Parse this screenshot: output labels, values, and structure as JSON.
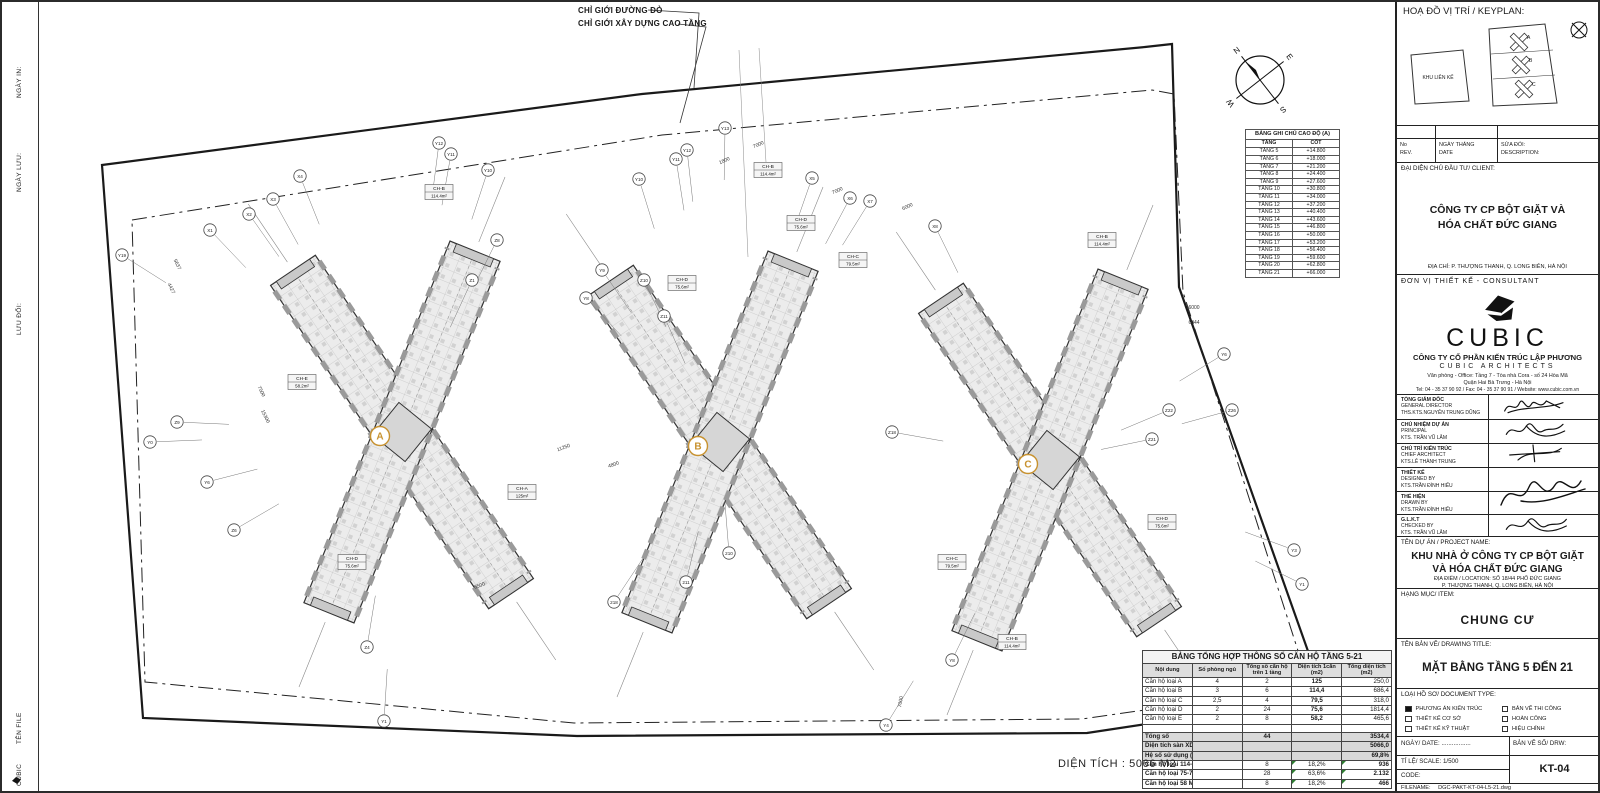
{
  "sheet": {
    "side_labels": [
      {
        "text": "NGÀY IN:",
        "top": 96
      },
      {
        "text": "NGÀY LƯU:",
        "top": 190
      },
      {
        "text": "LƯU ĐỔI:",
        "top": 333
      },
      {
        "text": "TÊN FILE",
        "top": 742
      },
      {
        "text": "CUBIC",
        "top": 784
      }
    ],
    "area_note": "DIỆN TÍCH : 5066 M2"
  },
  "drawing": {
    "boundary_label_1": "CHỈ GIỚI ĐƯỜNG ĐỎ",
    "boundary_label_2": "CHỈ GIỚI XÂY DỰNG CAO TẦNG",
    "tower_label_color": "#c8922f",
    "towers": [
      {
        "label": "A",
        "x": 400,
        "y": 430,
        "rot": -6
      },
      {
        "label": "B",
        "x": 718,
        "y": 440,
        "rot": -6
      },
      {
        "label": "C",
        "x": 1048,
        "y": 458,
        "rot": -6
      }
    ],
    "compass": {
      "n": "N",
      "e": "E",
      "s": "S",
      "w": "W"
    },
    "grid_bubbles": [
      {
        "l": "X1",
        "x": 208,
        "y": 228
      },
      {
        "l": "X2",
        "x": 247,
        "y": 212
      },
      {
        "l": "X3",
        "x": 271,
        "y": 197
      },
      {
        "l": "X4",
        "x": 298,
        "y": 174
      },
      {
        "l": "Y19",
        "x": 120,
        "y": 253
      },
      {
        "l": "Y12",
        "x": 437,
        "y": 141
      },
      {
        "l": "Y11",
        "x": 449,
        "y": 152
      },
      {
        "l": "Y10",
        "x": 486,
        "y": 168
      },
      {
        "l": "Z8",
        "x": 495,
        "y": 238
      },
      {
        "l": "Z1",
        "x": 470,
        "y": 278
      },
      {
        "l": "Y9",
        "x": 600,
        "y": 268
      },
      {
        "l": "Y8",
        "x": 584,
        "y": 296
      },
      {
        "l": "Z10",
        "x": 642,
        "y": 278
      },
      {
        "l": "Z11",
        "x": 662,
        "y": 314
      },
      {
        "l": "Z9",
        "x": 175,
        "y": 420
      },
      {
        "l": "Y0",
        "x": 148,
        "y": 440
      },
      {
        "l": "Y6",
        "x": 205,
        "y": 480
      },
      {
        "l": "Z6",
        "x": 232,
        "y": 528
      },
      {
        "l": "Z4",
        "x": 365,
        "y": 645
      },
      {
        "l": "Y1",
        "x": 382,
        "y": 719
      },
      {
        "l": "218",
        "x": 612,
        "y": 600
      },
      {
        "l": "Y13",
        "x": 723,
        "y": 126
      },
      {
        "l": "Y12",
        "x": 685,
        "y": 148
      },
      {
        "l": "Y11",
        "x": 674,
        "y": 157
      },
      {
        "l": "Y10",
        "x": 637,
        "y": 177
      },
      {
        "l": "X5",
        "x": 810,
        "y": 176
      },
      {
        "l": "X6",
        "x": 848,
        "y": 196
      },
      {
        "l": "X7",
        "x": 868,
        "y": 199
      },
      {
        "l": "X8",
        "x": 933,
        "y": 224
      },
      {
        "l": "210",
        "x": 727,
        "y": 551
      },
      {
        "l": "211",
        "x": 684,
        "y": 580
      },
      {
        "l": "Z18",
        "x": 890,
        "y": 430
      },
      {
        "l": "Y4",
        "x": 884,
        "y": 723
      },
      {
        "l": "Z21",
        "x": 1150,
        "y": 437
      },
      {
        "l": "Z22",
        "x": 1167,
        "y": 408
      },
      {
        "l": "Z26",
        "x": 1230,
        "y": 408
      },
      {
        "l": "Y6",
        "x": 1222,
        "y": 352
      },
      {
        "l": "Y8",
        "x": 950,
        "y": 658
      },
      {
        "l": "Y3",
        "x": 1292,
        "y": 548
      },
      {
        "l": "Y1",
        "x": 1300,
        "y": 582
      }
    ],
    "unit_labels": [
      {
        "code": "CH-B",
        "area": "114.4m²",
        "x": 766,
        "y": 168
      },
      {
        "code": "CH-D",
        "area": "75.6m²",
        "x": 799,
        "y": 221
      },
      {
        "code": "CH-C",
        "area": "79.5m²",
        "x": 851,
        "y": 258
      },
      {
        "code": "CH-D",
        "area": "75.6m²",
        "x": 680,
        "y": 281
      },
      {
        "code": "CH-B",
        "area": "114.4m²",
        "x": 437,
        "y": 190
      },
      {
        "code": "CH-E",
        "area": "58.2m²",
        "x": 300,
        "y": 380
      },
      {
        "code": "CH-A",
        "area": "125m²",
        "x": 520,
        "y": 490
      },
      {
        "code": "CH-B",
        "area": "114.4m²",
        "x": 1100,
        "y": 238
      },
      {
        "code": "CH-D",
        "area": "75.6m²",
        "x": 1160,
        "y": 520
      },
      {
        "code": "CH-C",
        "area": "79.5m²",
        "x": 950,
        "y": 560
      },
      {
        "code": "CH-D",
        "area": "75.6m²",
        "x": 350,
        "y": 560
      },
      {
        "code": "CH-B",
        "area": "114.4m²",
        "x": 1010,
        "y": 640
      }
    ],
    "dim_labels": [
      {
        "t": "7000",
        "x": 757,
        "y": 144,
        "r": -24
      },
      {
        "t": "1800",
        "x": 723,
        "y": 160,
        "r": -24
      },
      {
        "t": "6000",
        "x": 906,
        "y": 206,
        "r": -24
      },
      {
        "t": "7000",
        "x": 836,
        "y": 190,
        "r": -24
      },
      {
        "t": "11250",
        "x": 562,
        "y": 447,
        "r": -20
      },
      {
        "t": "4800",
        "x": 612,
        "y": 464,
        "r": -20
      },
      {
        "t": "7500",
        "x": 258,
        "y": 390,
        "r": 64
      },
      {
        "t": "5637",
        "x": 174,
        "y": 263,
        "r": 64
      },
      {
        "t": "4427",
        "x": 168,
        "y": 287,
        "r": 64
      },
      {
        "t": "6000",
        "x": 1192,
        "y": 307,
        "r": 0
      },
      {
        "t": "6044",
        "x": 1192,
        "y": 322,
        "r": 0
      },
      {
        "t": "15300",
        "x": 262,
        "y": 415,
        "r": 64
      },
      {
        "t": "6500",
        "x": 478,
        "y": 585,
        "r": -20
      },
      {
        "t": "7000",
        "x": 900,
        "y": 700,
        "r": -80
      }
    ]
  },
  "elevation_table": {
    "title": "BẢNG GHI CHÚ CAO ĐỘ (A)",
    "columns": [
      "TẦNG",
      "CỐT"
    ],
    "rows": [
      [
        "TẦNG 5",
        "+14.800"
      ],
      [
        "TẦNG 6",
        "+18.000"
      ],
      [
        "TẦNG 7",
        "+21.200"
      ],
      [
        "TẦNG 8",
        "+24.400"
      ],
      [
        "TẦNG 9",
        "+27.600"
      ],
      [
        "TẦNG 10",
        "+30.800"
      ],
      [
        "TẦNG 11",
        "+34.000"
      ],
      [
        "TẦNG 12",
        "+37.200"
      ],
      [
        "TẦNG 13",
        "+40.400"
      ],
      [
        "TẦNG 14",
        "+43.600"
      ],
      [
        "TẦNG 15",
        "+46.800"
      ],
      [
        "TẦNG 16",
        "+50.000"
      ],
      [
        "TẦNG 17",
        "+53.200"
      ],
      [
        "TẦNG 18",
        "+56.400"
      ],
      [
        "TẦNG 19",
        "+59.600"
      ],
      [
        "TẦNG 20",
        "+62.800"
      ],
      [
        "TẦNG 21",
        "+66.000"
      ]
    ]
  },
  "summary_table": {
    "title": "BẢNG TỔNG HỢP THÔNG SỐ CĂN HỘ TẦNG 5-21",
    "columns": [
      "Nội dung",
      "Số phòng ngủ",
      "Tổng số căn hộ trên 1 tầng",
      "Diện tích 1căn (m2)",
      "Tổng diện tích (m2)"
    ],
    "rows": [
      {
        "kind": "data",
        "cells": [
          "Căn hộ loại A",
          "4",
          "2",
          "125",
          "250,0"
        ]
      },
      {
        "kind": "data",
        "cells": [
          "Căn hộ loại B",
          "3",
          "6",
          "114,4",
          "686,4"
        ]
      },
      {
        "kind": "data",
        "cells": [
          "Căn hộ loại C",
          "2,5",
          "4",
          "79,5",
          "318,0"
        ]
      },
      {
        "kind": "data",
        "cells": [
          "Căn hộ loại D",
          "2",
          "24",
          "75,6",
          "1814,4"
        ]
      },
      {
        "kind": "data",
        "cells": [
          "Căn hộ loại E",
          "2",
          "8",
          "58,2",
          "465,6"
        ]
      },
      {
        "kind": "blank",
        "cells": [
          "",
          "",
          "",
          "",
          ""
        ]
      },
      {
        "kind": "tot",
        "cells": [
          "Tổng số",
          "",
          "44",
          "",
          "3534,4"
        ]
      },
      {
        "kind": "tot",
        "cells": [
          "Diện tích sàn XD 1 tầng",
          "",
          "",
          "",
          "5066,0"
        ]
      },
      {
        "kind": "tot",
        "cells": [
          "Hệ số sử dụng ( k % )",
          "",
          "",
          "",
          "69,8%"
        ]
      },
      {
        "kind": "spec",
        "cells": [
          "Căn hộ loại 114-125 M2",
          "",
          "8",
          "18,2%",
          "936"
        ]
      },
      {
        "kind": "spec",
        "cells": [
          "Căn hộ loại 75-79 M2",
          "",
          "28",
          "63,6%",
          "2.132"
        ]
      },
      {
        "kind": "spec",
        "cells": [
          "Căn hộ loại 58 M2",
          "",
          "8",
          "18,2%",
          "466"
        ]
      }
    ]
  },
  "titleblock": {
    "keyplan_header": "HOẠ ĐỒ VỊ TRÍ / KEYPLAN:",
    "keyplan": {
      "adjacent_label": "KHU LIÊN KẾ",
      "tower_labels": [
        "A",
        "B",
        "C"
      ]
    },
    "rev_cells": [
      [
        "No",
        "REV."
      ],
      [
        "NGÀY THÁNG",
        "DATE"
      ],
      [
        "SỬA ĐỔI:",
        "DESCRIPTION:"
      ]
    ],
    "client_header": "ĐẠI DIỆN CHỦ ĐẦU TƯ/ CLIENT:",
    "client_name_1": "CÔNG TY CP BỘT GIẶT VÀ",
    "client_name_2": "HÓA CHẤT ĐỨC GIANG",
    "client_address": "ĐỊA CHỈ: P. THƯỢNG THANH, Q. LONG BIÊN, HÀ NỘI",
    "consultant_header": "ĐƠN VỊ THIẾT KẾ  - CONSULTANT",
    "logo_text": "CUBIC",
    "company_vn": "CÔNG TY CỔ PHẦN KIẾN TRÚC LẬP PHƯƠNG",
    "company_en": "CUBIC ARCHITECTS",
    "office_line1": "Văn phòng - Office: Tầng 7 - Tòa nhà Cora - số 24 Hòa Mã",
    "office_line2": "Quận Hai Bà Trưng - Hà Nội",
    "office_line3": "Tel:  04 - 35 37 90 92 / Fax: 04 - 35 37 90 91 /  Website: www.cubic.com.vn",
    "signatures": [
      {
        "vn": "TỔNG GIÁM ĐỐC",
        "en": "GENERAL DIRECTOR",
        "name": "THS.KTS.NGUYỄN TRUNG DŨNG"
      },
      {
        "vn": "CHỦ NHIỆM DỰ ÁN",
        "en": "PRINCIPAL",
        "name": "KTS. TRẦN VŨ LÂM"
      },
      {
        "vn": "CHỦ TRÌ KIẾN TRÚC",
        "en": "CHIEF ARCHITECT",
        "name": "KTS.LÊ THÀNH TRUNG"
      },
      {
        "vn": "THIẾT KẾ",
        "en": "DESIGNED BY",
        "name": "KTS.TRẦN ĐÌNH HIẾU"
      },
      {
        "vn": "THỂ HIỆN",
        "en": "DRAWN BY",
        "name": "KTS.TRẦN ĐÌNH HIẾU"
      },
      {
        "vn": "G.L.K.T",
        "en": "CHECKED BY",
        "name": "KTS. TRẦN VŨ LÂM"
      }
    ],
    "project_header": "TÊN DỰ ÁN / PROJECT NAME:",
    "project_name_1": "KHU NHÀ Ở CÔNG TY CP BỘT GIẶT",
    "project_name_2": "VÀ HÓA CHẤT ĐỨC GIANG",
    "project_loc_1": "ĐỊA ĐIỂM / LOCATION: SỐ 18/44 PHỐ ĐỨC GIANG",
    "project_loc_2": "P. THƯỢNG THANH, Q. LONG BIÊN, HÀ NỘI",
    "item_header": "HẠNG MỤC/ ITEM:",
    "item_name": "CHUNG CƯ",
    "title_header": "TÊN BẢN VẼ/ DRAWING TITLE:",
    "drawing_title": "MẶT BẰNG TẦNG 5 ĐẾN 21",
    "doctype_header": "LOẠI HỒ SƠ/ DOCUMENT TYPE:",
    "doctype_options": [
      {
        "label": "PHƯƠNG ÁN KIẾN TRÚC",
        "checked": true
      },
      {
        "label": "THIẾT KẾ CƠ SỞ",
        "checked": false
      },
      {
        "label": "THIẾT KẾ KỸ THUẬT",
        "checked": false
      },
      {
        "label": "BẢN VẼ THI CÔNG",
        "checked": false
      },
      {
        "label": "HOÀN CÔNG",
        "checked": false
      },
      {
        "label": "HIỆU CHỈNH",
        "checked": false
      }
    ],
    "date_label": "NGÀY/ DATE:  .................",
    "drw_label": "BẢN VẼ SỐ/ DRW:",
    "scale_label": "TỈ LỆ/ SCALE:  1/500",
    "drawing_number": "KT-04",
    "code_label": "CODE:",
    "filename_label": "FILENAME:",
    "filename_value": "DGC-PAKT-KT-04-L5-21.dwg"
  }
}
